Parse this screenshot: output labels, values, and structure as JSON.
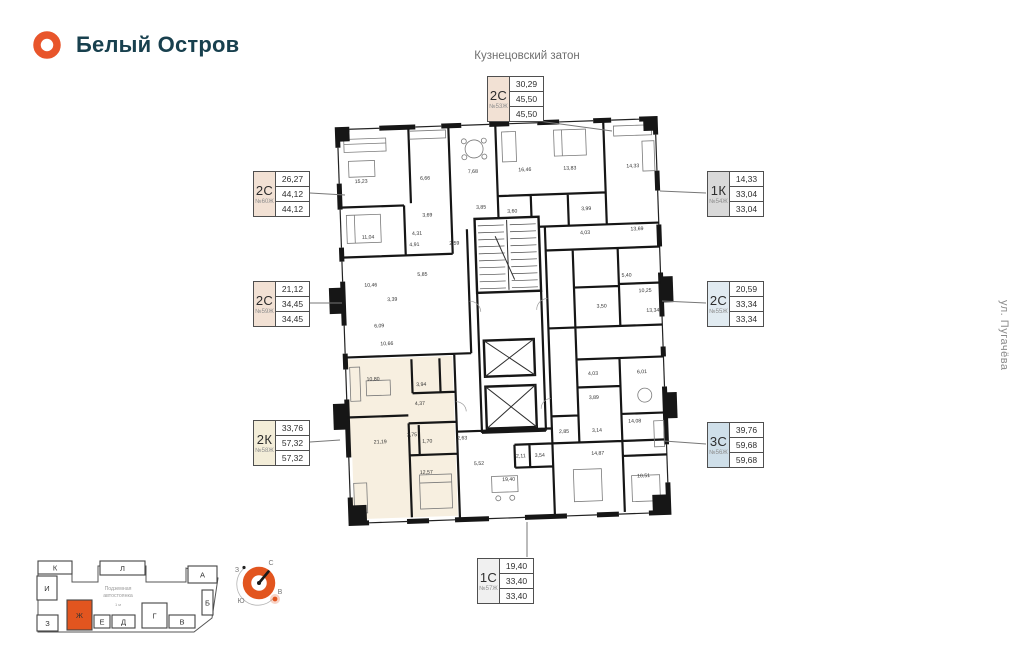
{
  "brand": {
    "name": "Белый Остров"
  },
  "context_labels": {
    "top_street": "Кузнецовский затон",
    "right_street": "ул. Пугачёва"
  },
  "colors": {
    "accent_orange": "#e2551f",
    "brand_text": "#18404e",
    "highlight_beige": "#f7efe0",
    "type_2c": "#f2e1d4",
    "type_2k": "#f3edd8",
    "type_1k": "#d9d9d9",
    "type_3c": "#cfdfe9",
    "type_1c": "#f0f0f0"
  },
  "badges": [
    {
      "type": "2С",
      "number": "№53Ж",
      "values": [
        "30,29",
        "45,50",
        "45,50"
      ],
      "color": "#f2e1d4"
    },
    {
      "type": "2С",
      "number": "№60Ж",
      "values": [
        "26,27",
        "44,12",
        "44,12"
      ],
      "color": "#f2e1d4"
    },
    {
      "type": "2С",
      "number": "№59Ж",
      "values": [
        "21,12",
        "34,45",
        "34,45"
      ],
      "color": "#f2e1d4"
    },
    {
      "type": "2К",
      "number": "№58Ж",
      "values": [
        "33,76",
        "57,32",
        "57,32"
      ],
      "color": "#f3edd8"
    },
    {
      "type": "1К",
      "number": "№54Ж",
      "values": [
        "14,33",
        "33,04",
        "33,04"
      ],
      "color": "#d9d9d9"
    },
    {
      "type": "2С",
      "number": "№55Ж",
      "values": [
        "20,59",
        "33,34",
        "33,34"
      ],
      "color": "#cfdfe9a0"
    },
    {
      "type": "3С",
      "number": "№56Ж",
      "values": [
        "39,76",
        "59,68",
        "59,68"
      ],
      "color": "#cfdfe9"
    },
    {
      "type": "1С",
      "number": "№57Ж",
      "values": [
        "19,40",
        "33,40",
        "33,40"
      ],
      "color": "#f0f0f0"
    }
  ],
  "floor_plan": {
    "highlight_color": "#f7efe0",
    "rooms": [
      {
        "area": "15,23",
        "x": 46,
        "y": 78
      },
      {
        "area": "6,66",
        "x": 110,
        "y": 77
      },
      {
        "area": "7,68",
        "x": 158,
        "y": 72
      },
      {
        "area": "16,46",
        "x": 210,
        "y": 72
      },
      {
        "area": "13,83",
        "x": 255,
        "y": 72
      },
      {
        "area": "14,33",
        "x": 318,
        "y": 72
      },
      {
        "area": "11,04",
        "x": 51,
        "y": 134
      },
      {
        "area": "4,31",
        "x": 100,
        "y": 132
      },
      {
        "area": "3,69",
        "x": 111,
        "y": 114
      },
      {
        "area": "4,91",
        "x": 97,
        "y": 143
      },
      {
        "area": "2,59",
        "x": 137,
        "y": 143
      },
      {
        "area": "3,85",
        "x": 165,
        "y": 108
      },
      {
        "area": "3,60",
        "x": 196,
        "y": 113
      },
      {
        "area": "3,99",
        "x": 270,
        "y": 113
      },
      {
        "area": "4,03",
        "x": 268,
        "y": 137
      },
      {
        "area": "13,69",
        "x": 320,
        "y": 135
      },
      {
        "area": "10,46",
        "x": 52,
        "y": 182
      },
      {
        "area": "3,39",
        "x": 73,
        "y": 197
      },
      {
        "area": "5,85",
        "x": 104,
        "y": 173
      },
      {
        "area": "6,09",
        "x": 59,
        "y": 223
      },
      {
        "area": "10,66",
        "x": 66,
        "y": 241
      },
      {
        "area": "5,40",
        "x": 308,
        "y": 181
      },
      {
        "area": "10,25",
        "x": 326,
        "y": 197
      },
      {
        "area": "13,34",
        "x": 333,
        "y": 217
      },
      {
        "area": "3,50",
        "x": 282,
        "y": 211
      },
      {
        "area": "10,80",
        "x": 51,
        "y": 276
      },
      {
        "area": "3,94",
        "x": 99,
        "y": 283
      },
      {
        "area": "4,37",
        "x": 97,
        "y": 302
      },
      {
        "area": "2,75",
        "x": 88,
        "y": 333
      },
      {
        "area": "1,70",
        "x": 103,
        "y": 340
      },
      {
        "area": "21,19",
        "x": 56,
        "y": 339
      },
      {
        "area": "12,57",
        "x": 101,
        "y": 371
      },
      {
        "area": "2,63",
        "x": 138,
        "y": 338
      },
      {
        "area": "5,52",
        "x": 154,
        "y": 364
      },
      {
        "area": "19,40",
        "x": 183,
        "y": 381
      },
      {
        "area": "4,03",
        "x": 271,
        "y": 278
      },
      {
        "area": "6,01",
        "x": 320,
        "y": 278
      },
      {
        "area": "3,89",
        "x": 271,
        "y": 302
      },
      {
        "area": "14,08",
        "x": 311,
        "y": 327
      },
      {
        "area": "2,85",
        "x": 240,
        "y": 335
      },
      {
        "area": "3,14",
        "x": 273,
        "y": 335
      },
      {
        "area": "2,11",
        "x": 196,
        "y": 358
      },
      {
        "area": "3,54",
        "x": 215,
        "y": 358
      },
      {
        "area": "14,87",
        "x": 273,
        "y": 358
      },
      {
        "area": "10,51",
        "x": 318,
        "y": 382
      }
    ]
  },
  "site_map": {
    "parking_label_1": "Подземная",
    "parking_label_2": "автостоянка",
    "parking_label_3": "1 м",
    "highlighted_section": "Ж",
    "sections": [
      {
        "label": "К",
        "x": 10,
        "y": 5,
        "w": 34,
        "h": 13
      },
      {
        "label": "Л",
        "x": 72,
        "y": 5,
        "w": 45,
        "h": 14
      },
      {
        "label": "А",
        "x": 160,
        "y": 10,
        "w": 29,
        "h": 17
      },
      {
        "label": "И",
        "x": 9,
        "y": 20,
        "w": 20,
        "h": 24
      },
      {
        "label": "З",
        "x": 9,
        "y": 59,
        "w": 21,
        "h": 16
      },
      {
        "label": "Б",
        "x": 174,
        "y": 34,
        "w": 11,
        "h": 25
      },
      {
        "label": "Ж",
        "x": 39,
        "y": 44,
        "w": 25,
        "h": 30,
        "highlight": true
      },
      {
        "label": "Е",
        "x": 66,
        "y": 59,
        "w": 16,
        "h": 13
      },
      {
        "label": "Д",
        "x": 84,
        "y": 59,
        "w": 23,
        "h": 13
      },
      {
        "label": "Г",
        "x": 114,
        "y": 47,
        "w": 25,
        "h": 25
      },
      {
        "label": "В",
        "x": 141,
        "y": 59,
        "w": 26,
        "h": 13
      }
    ]
  },
  "compass": {
    "north": "С",
    "east": "В",
    "south": "Ю",
    "west": "З"
  }
}
